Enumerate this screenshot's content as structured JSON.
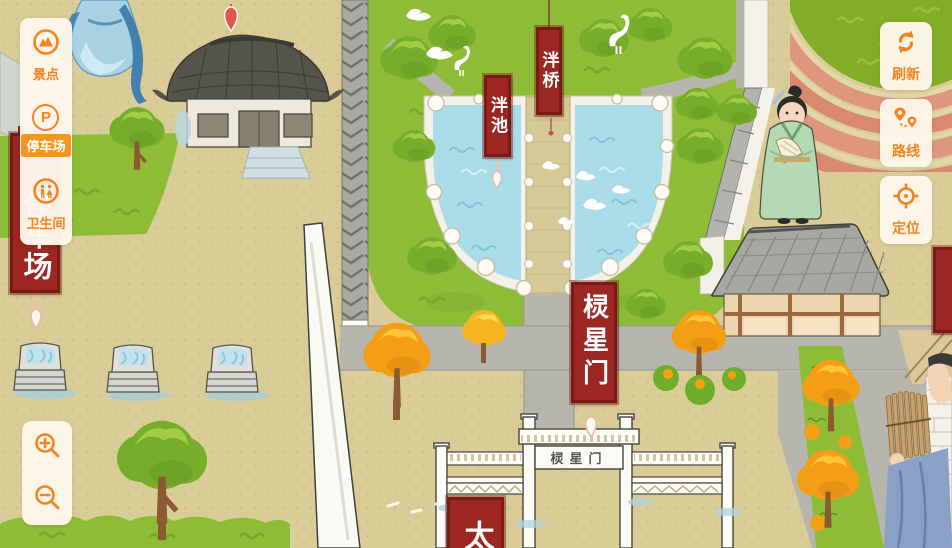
{
  "app": {
    "description": "Hand-drawn scenic area interactive map (Confucian temple complex)"
  },
  "colors": {
    "accent_orange": "#F5831F",
    "selected_orange": "#F7941D",
    "panel_cream": "#FDF6EA",
    "banner_red": "#9B2622",
    "banner_border": "#7A1A14",
    "water_blue": "#A9DCE8",
    "lawn_green": "#8FBC37",
    "road_gray": "#B7B6AE",
    "ground_tan": "#D9CC97"
  },
  "left_menu": {
    "items": [
      {
        "label": "景点",
        "icon": "scenic-spots-icon",
        "selected": false
      },
      {
        "label": "停车场",
        "icon": "parking-icon",
        "glyph": "P",
        "selected": true
      },
      {
        "label": "卫生间",
        "icon": "restroom-icon",
        "selected": false
      }
    ]
  },
  "right_menu": {
    "items": [
      {
        "label": "刷新",
        "icon": "refresh-icon"
      },
      {
        "label": "路线",
        "icon": "route-icon"
      },
      {
        "label": "定位",
        "icon": "locate-icon"
      }
    ]
  },
  "zoom_controls": {
    "zoom_in_icon": "zoom-in-icon",
    "zoom_out_icon": "zoom-out-icon"
  },
  "map": {
    "banners": {
      "pan_bridge": "泮桥",
      "pan_pond": "泮池",
      "lingxing_gate": "棂星门",
      "parking": "停车场",
      "bottom_partial": "太",
      "right_edge": ""
    },
    "gate_plaque": "棂星门"
  }
}
